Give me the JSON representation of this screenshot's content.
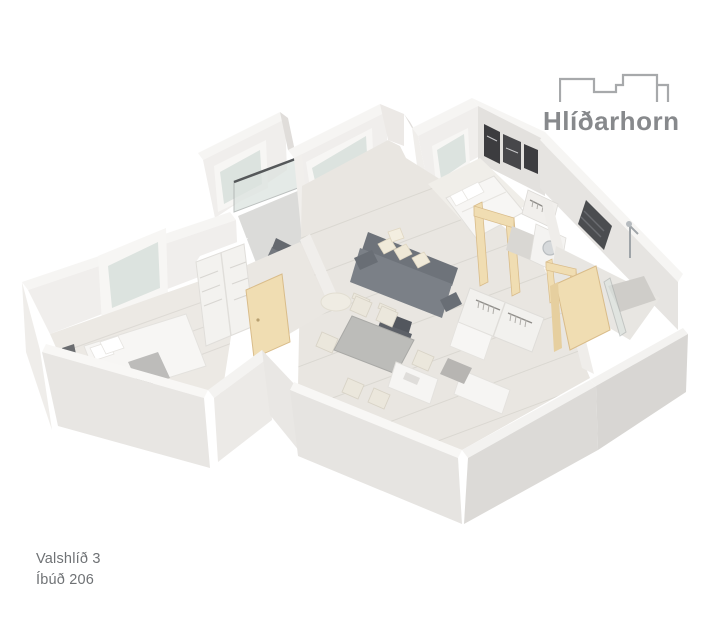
{
  "brand": {
    "name": "Hlíðarhorn",
    "icon": "building-outline-icon",
    "text_color": "#87898c",
    "icon_color": "#a7a9ab"
  },
  "footer": {
    "address": "Valshlíð 3",
    "unit": "Íbúð 206",
    "text_color": "#6f7275"
  },
  "scene": {
    "type": "3d-isometric-floorplan",
    "rooms": [
      {
        "name": "bedroom-1",
        "furniture": [
          "double-bed",
          "gray-runner",
          "pillows",
          "wardrobe-shelving",
          "window"
        ]
      },
      {
        "name": "corridor",
        "furniture": [
          "wardrobe-drawers",
          "wood-door"
        ]
      },
      {
        "name": "balcony",
        "furniture": [
          "glass-railing",
          "lounge-chair",
          "glass-door"
        ]
      },
      {
        "name": "living-room",
        "furniture": [
          "gray-sofa",
          "cream-pillows",
          "round-coffee-table",
          "dark-armchair",
          "window"
        ]
      },
      {
        "name": "dining-area",
        "furniture": [
          "dining-table",
          "six-chairs"
        ]
      },
      {
        "name": "kitchen",
        "furniture": [
          "white-counters",
          "doormat"
        ]
      },
      {
        "name": "bedroom-2",
        "furniture": [
          "double-bed",
          "wall-art-frames",
          "window",
          "door-frame"
        ]
      },
      {
        "name": "hall",
        "furniture": [
          "washing-machine",
          "hanger-closets",
          "white-cabinet",
          "open-wood-doors"
        ]
      },
      {
        "name": "bathroom",
        "furniture": [
          "shower",
          "towel-radiator",
          "glass-panel"
        ]
      }
    ],
    "palette": {
      "wall_light": "#ece9e6",
      "wall_mid": "#e0ddda",
      "wall_dark": "#d6d3d0",
      "wall_top": "#f8f7f5",
      "floor_wood": "#e9e6e1",
      "glass": "#dce3df",
      "door_wood": "#f0ddb2",
      "sofa_gray": "#7b8087",
      "dark_accent": "#47494d"
    }
  }
}
